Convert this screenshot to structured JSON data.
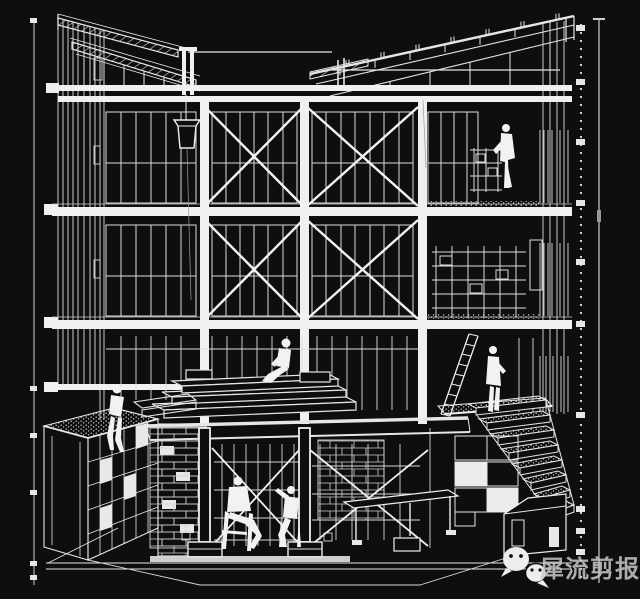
{
  "canvas": {
    "width": 640,
    "height": 599,
    "background_color": "#0e0e0e",
    "line_color": "#e6e6e6"
  },
  "watermark": {
    "icon": "wechat-icon",
    "account_name": "犀流剪报",
    "text_color": "rgba(200,200,200,0.85)"
  },
  "dimension_guides": {
    "left_axis_x": 34,
    "left_tick_ys": [
      18,
      386,
      433,
      490,
      561,
      575
    ],
    "right_axis_x": 581,
    "right_tick_ys": [
      25,
      79,
      139,
      200,
      259,
      321,
      412,
      506,
      528,
      549
    ],
    "right_outer_axis_x": 599
  },
  "scene": {
    "type": "axonometric-cutaway-building-section",
    "people": [
      "worker-standing-third-floor-right",
      "person-sitting-on-stage-platform",
      "person-sitting-on-kiosk-roof",
      "man-seated-in-conversation-basement-left",
      "man-seated-in-conversation-basement-right",
      "person-standing-at-stair-landing"
    ],
    "elements": [
      "shed-roof-rafters",
      "hatched-canopy-beams",
      "cross-braced-window-bays",
      "hanging-bucket-hoist",
      "ladder",
      "exterior-stairs-with-gravel-treads",
      "gravel-roof-kiosk",
      "brick-walls",
      "basement-scaffolding",
      "column-pedestals"
    ]
  }
}
